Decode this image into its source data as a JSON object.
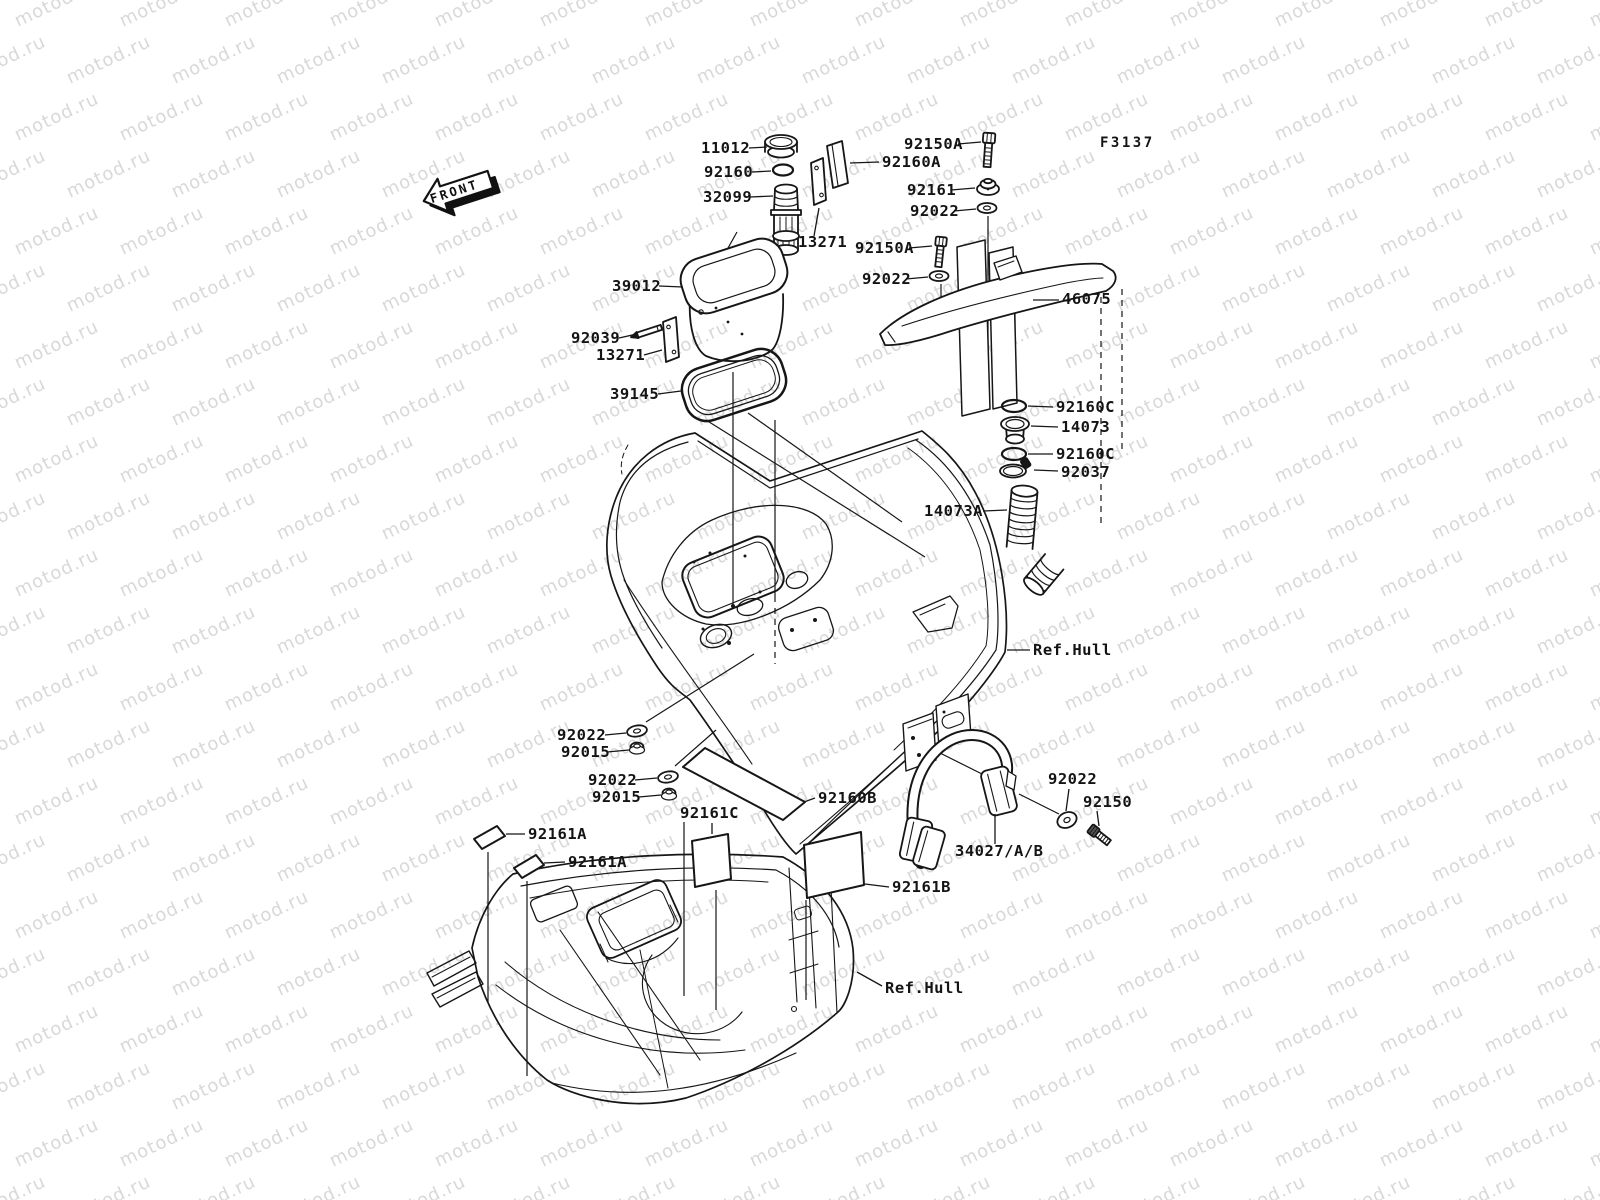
{
  "page": {
    "background": "#ffffff",
    "line_color": "#161616",
    "label_color": "#141414"
  },
  "watermark": {
    "text": "motod.ru",
    "color": "#d8d8d8",
    "rotation": -25,
    "row_step": 57,
    "col_step": 105,
    "row_offset": 52,
    "font_size": 18
  },
  "diagram": {
    "figure_code": {
      "text": "F3137",
      "x": 1100,
      "y": 147
    },
    "front_marker": {
      "text": "FRONT",
      "x": 458,
      "y": 190,
      "rotation": -18
    },
    "ref_label_text": "Ref.Hull",
    "labels": [
      {
        "key": "11012",
        "text": "11012",
        "x": 701,
        "y": 153,
        "leader": [
          749,
          148,
          767,
          147
        ]
      },
      {
        "key": "92160",
        "text": "92160",
        "x": 704,
        "y": 177,
        "leader": [
          752,
          172,
          771,
          171
        ]
      },
      {
        "key": "32099",
        "text": "32099",
        "x": 703,
        "y": 202,
        "leader": [
          750,
          197,
          773,
          196
        ]
      },
      {
        "key": "13271-r",
        "text": "13271",
        "x": 798,
        "y": 247,
        "leader": [
          814,
          236,
          819,
          208
        ]
      },
      {
        "key": "39012",
        "text": "39012",
        "x": 612,
        "y": 291,
        "leader": [
          659,
          286,
          683,
          287
        ]
      },
      {
        "key": "92039",
        "text": "92039",
        "x": 571,
        "y": 343,
        "leader": [
          619,
          338,
          637,
          334
        ]
      },
      {
        "key": "13271-l",
        "text": "13271",
        "x": 596,
        "y": 360,
        "leader": [
          644,
          355,
          662,
          350
        ]
      },
      {
        "key": "39145",
        "text": "39145",
        "x": 610,
        "y": 399,
        "leader": [
          658,
          394,
          681,
          391
        ]
      },
      {
        "key": "92150A-1",
        "text": "92150A",
        "x": 904,
        "y": 149,
        "leader": [
          958,
          144,
          981,
          142
        ]
      },
      {
        "key": "92160A",
        "text": "92160A",
        "x": 882,
        "y": 167,
        "leader": [
          879,
          162,
          850,
          163
        ]
      },
      {
        "key": "92161",
        "text": "92161",
        "x": 907,
        "y": 195,
        "leader": [
          951,
          190,
          975,
          188
        ]
      },
      {
        "key": "92022-1",
        "text": "92022",
        "x": 910,
        "y": 216,
        "leader": [
          954,
          211,
          976,
          209
        ]
      },
      {
        "key": "92150A-2",
        "text": "92150A",
        "x": 855,
        "y": 253,
        "leader": [
          909,
          248,
          932,
          246
        ]
      },
      {
        "key": "92022-2",
        "text": "92022",
        "x": 862,
        "y": 284,
        "leader": [
          906,
          279,
          928,
          277
        ]
      },
      {
        "key": "46075",
        "text": "46075",
        "x": 1062,
        "y": 304,
        "leader": [
          1059,
          300,
          1033,
          300
        ]
      },
      {
        "key": "92160C-1",
        "text": "92160C",
        "x": 1056,
        "y": 412,
        "leader": [
          1053,
          407,
          1028,
          406
        ]
      },
      {
        "key": "14073",
        "text": "14073",
        "x": 1061,
        "y": 432,
        "leader": [
          1058,
          427,
          1031,
          426
        ]
      },
      {
        "key": "92160C-2",
        "text": "92160C",
        "x": 1056,
        "y": 459,
        "leader": [
          1053,
          454,
          1028,
          454
        ]
      },
      {
        "key": "92037",
        "text": "92037",
        "x": 1061,
        "y": 477,
        "leader": [
          1058,
          471,
          1034,
          470
        ]
      },
      {
        "key": "14073A",
        "text": "14073A",
        "x": 924,
        "y": 516,
        "leader": [
          983,
          511,
          1007,
          510
        ]
      },
      {
        "key": "ref-hull-top",
        "text": "Ref.Hull",
        "x": 1033,
        "y": 655,
        "leader": [
          1030,
          650,
          1007,
          650
        ]
      },
      {
        "key": "92022-3",
        "text": "92022",
        "x": 557,
        "y": 740,
        "leader": [
          605,
          735,
          626,
          733
        ]
      },
      {
        "key": "92015-1",
        "text": "92015",
        "x": 561,
        "y": 757,
        "leader": [
          607,
          752,
          629,
          750
        ]
      },
      {
        "key": "92022-4",
        "text": "92022",
        "x": 588,
        "y": 785,
        "leader": [
          635,
          780,
          657,
          778
        ]
      },
      {
        "key": "92015-2",
        "text": "92015",
        "x": 592,
        "y": 802,
        "leader": [
          639,
          797,
          661,
          795
        ]
      },
      {
        "key": "92160B",
        "text": "92160B",
        "x": 818,
        "y": 803,
        "leader": [
          815,
          798,
          804,
          802
        ]
      },
      {
        "key": "92161C",
        "text": "92161C",
        "x": 680,
        "y": 818,
        "leader": [
          712,
          823,
          712,
          834
        ]
      },
      {
        "key": "92161A-1",
        "text": "92161A",
        "x": 528,
        "y": 839,
        "leader": [
          525,
          834,
          506,
          834
        ]
      },
      {
        "key": "92161A-2",
        "text": "92161A",
        "x": 568,
        "y": 867,
        "leader": [
          565,
          862,
          544,
          863
        ]
      },
      {
        "key": "92161B",
        "text": "92161B",
        "x": 892,
        "y": 892,
        "leader": [
          889,
          887,
          865,
          884
        ]
      },
      {
        "key": "92022-5",
        "text": "92022",
        "x": 1048,
        "y": 784,
        "leader": [
          1069,
          789,
          1066,
          811
        ]
      },
      {
        "key": "92150",
        "text": "92150",
        "x": 1083,
        "y": 807,
        "leader": [
          1097,
          811,
          1099,
          826
        ]
      },
      {
        "key": "34027AB",
        "text": "34027/A/B",
        "x": 955,
        "y": 856,
        "leader": [
          995,
          844,
          995,
          814
        ]
      },
      {
        "key": "ref-hull-bottom",
        "text": "Ref.Hull",
        "x": 885,
        "y": 993,
        "leader": [
          882,
          986,
          857,
          972
        ]
      }
    ]
  }
}
